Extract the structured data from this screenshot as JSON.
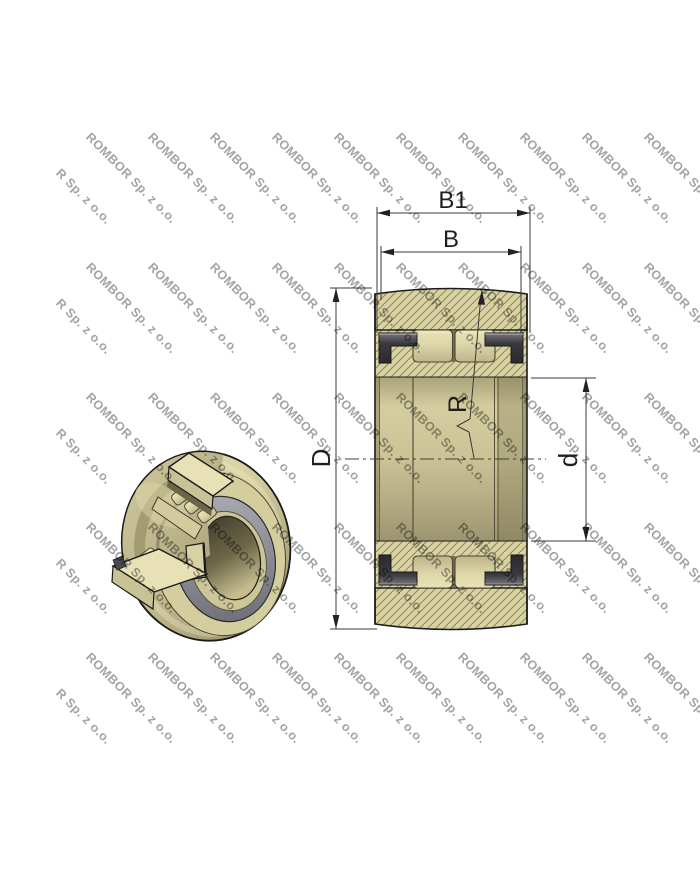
{
  "watermark": {
    "text": "ROMBOR Sp. z o.o.",
    "partial_text": "R Sp. z o.o.",
    "color": "#9f9f9f",
    "angle_deg": 45,
    "row_ys": [
      130,
      260,
      390,
      520,
      650
    ],
    "col_xs": [
      93,
      155,
      217,
      279,
      341,
      403,
      465,
      527,
      589,
      651
    ],
    "partial_col_x": 63,
    "partial_row_offset": 36
  },
  "drawing": {
    "dimension_labels": {
      "overall_width": "B1",
      "ring_width": "B",
      "outer_diameter": "D",
      "bore_diameter": "d",
      "crown_radius": "R"
    },
    "colors": {
      "body_tan": "#d9d2a2",
      "hatch_line": "#8f8960",
      "washer_dark": "#3a3a3e",
      "inner_ring_gray": "#90909a",
      "outline": "#1c1c1c",
      "dim_color": "#3a3a3a",
      "label_color": "#1f1f1f"
    }
  }
}
